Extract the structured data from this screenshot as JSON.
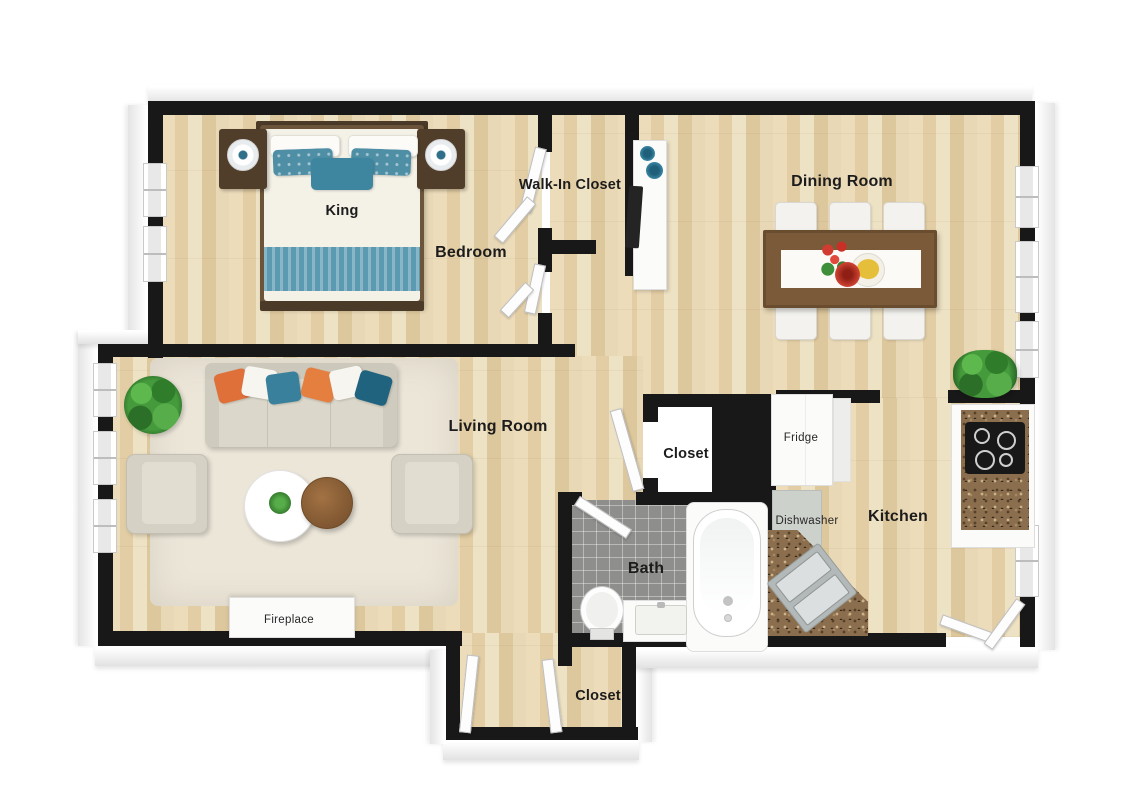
{
  "plan": {
    "labels": {
      "bed": "King",
      "bedroom": "Bedroom",
      "walk_in_closet": "Walk-In Closet",
      "dining_room": "Dining Room",
      "living_room": "Living Room",
      "closet_middle": "Closet",
      "closet_entry": "Closet",
      "kitchen": "Kitchen",
      "bath": "Bath",
      "fridge": "Fridge",
      "dishwasher": "Dishwasher",
      "fireplace": "Fireplace"
    },
    "colors": {
      "wall": "#181818",
      "wood_floor": "#e7d6b3",
      "bath_tile": "#8e8e8c",
      "granite_counter": "#8a6e4d",
      "accent_teal": "#3e85a0",
      "accent_orange": "#e0703a",
      "sofa_beige": "#dbd7ca",
      "rug_beige": "#ece6d9",
      "table_brown": "#7b5a39",
      "plant_green": "#459a3c",
      "label_text": "#1c1c1c"
    }
  }
}
